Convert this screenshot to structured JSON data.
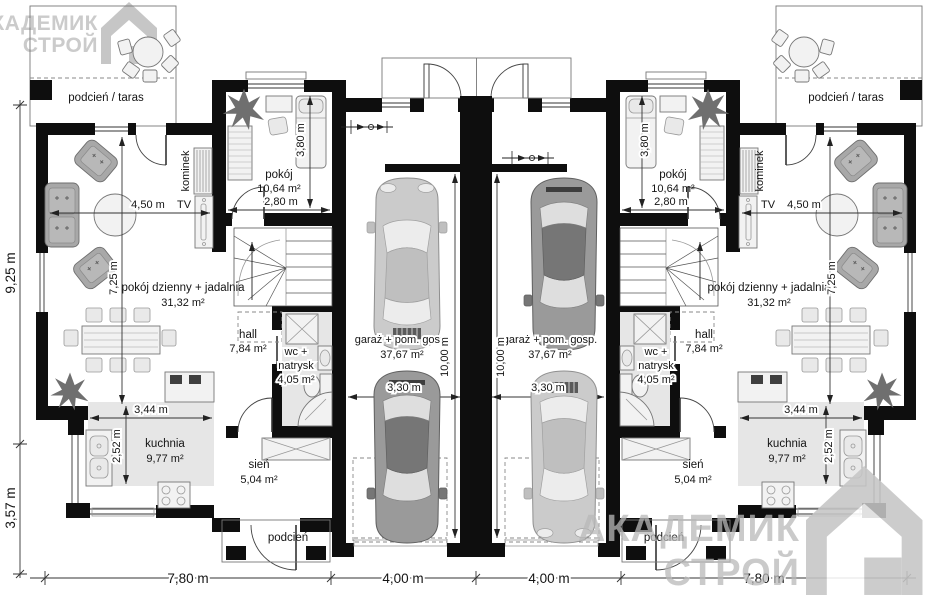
{
  "watermark": {
    "line1": "АКАДЕМИК",
    "line2": "СТРОЙ"
  },
  "rooms": {
    "terrace": "podcień / taras",
    "living_name": "pokój dzienny + jadalnia",
    "living_area": "31,32 m²",
    "bedroom_name": "pokój",
    "bedroom_area": "10,64 m²",
    "hall_name": "hall",
    "hall_area": "7,84 m²",
    "wc_line1": "wc +",
    "wc_line2": "natrysk",
    "wc_area": "4,05 m²",
    "kitchen_name": "kuchnia",
    "kitchen_area": "9,77 m²",
    "vestibule_name": "sień",
    "vestibule_area": "5,04 m²",
    "garage_name": "garaż + pom. gosp.",
    "garage_area": "37,67 m²",
    "porch": "podcień"
  },
  "annotations": {
    "tv": "TV",
    "fireplace": "kominek"
  },
  "dimensions": {
    "bottom": [
      "7,80 m",
      "4,00 m",
      "4,00 m",
      "7,80 m"
    ],
    "depth_main": "9,25 m",
    "depth_bay": "3,57 m",
    "living_width": "4,50 m",
    "living_depth": "7,25 m",
    "bedroom_width": "2,80 m",
    "bed_length": "3,80 m",
    "kitchen_width": "3,44 m",
    "kitchen_depth": "2,52 m",
    "garage_length": "10,00 m",
    "garage_car_width": "3,30 m"
  }
}
